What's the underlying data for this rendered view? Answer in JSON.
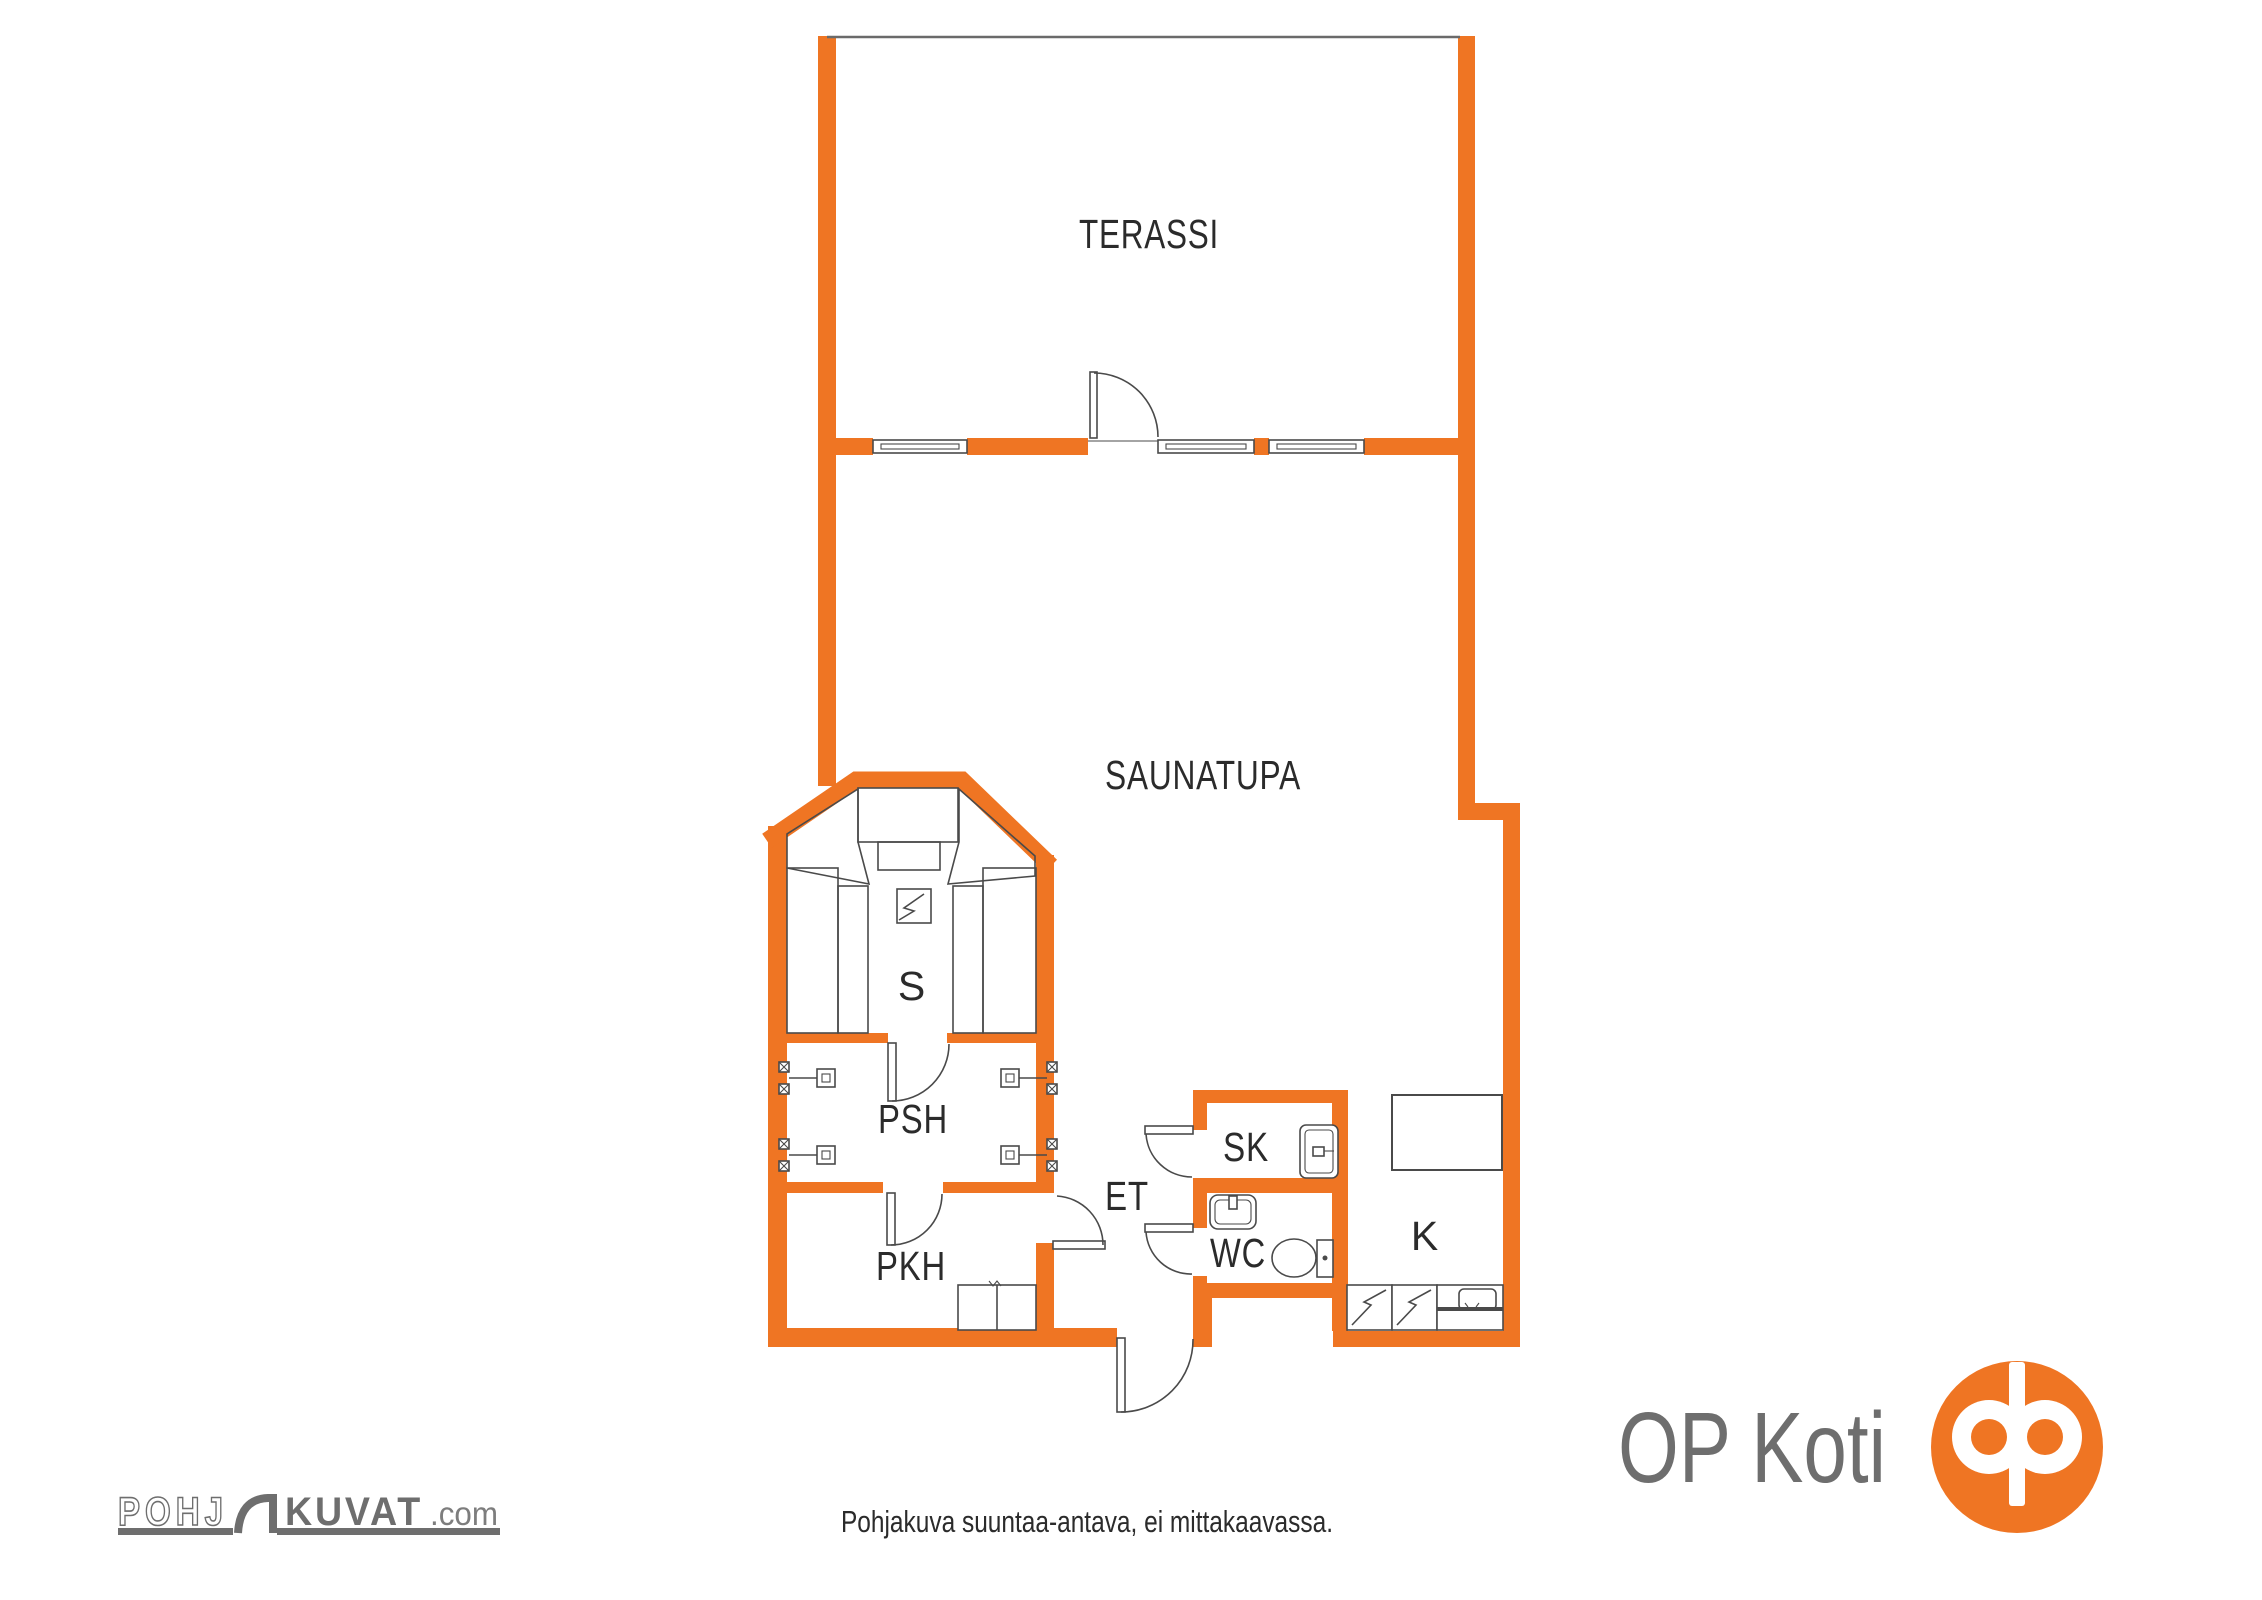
{
  "colors": {
    "wall": "#EF7523",
    "brand": "#EF7523",
    "line": "#4A4A4A",
    "topline": "#6A6A6A",
    "text": "#2B2B2B",
    "logogray": "#6E6E6E",
    "logograylight": "#7D7D7D"
  },
  "rooms": {
    "terassi": {
      "label": "TERASSI"
    },
    "saunatupa": {
      "label": "SAUNATUPA"
    },
    "sauna": {
      "label": "S"
    },
    "psh": {
      "label": "PSH"
    },
    "pkh": {
      "label": "PKH"
    },
    "et": {
      "label": "ET"
    },
    "sk": {
      "label": "SK"
    },
    "wc": {
      "label": "WC"
    },
    "k": {
      "label": "K"
    }
  },
  "footer": {
    "disclaimer": "Pohjakuva suuntaa-antava, ei mittakaavassa."
  },
  "logos": {
    "pohjakuvat": {
      "part1": "POHJ",
      "part2": "KUVAT",
      "part3": ".com"
    },
    "opkoti": {
      "text": "OP Koti"
    }
  }
}
